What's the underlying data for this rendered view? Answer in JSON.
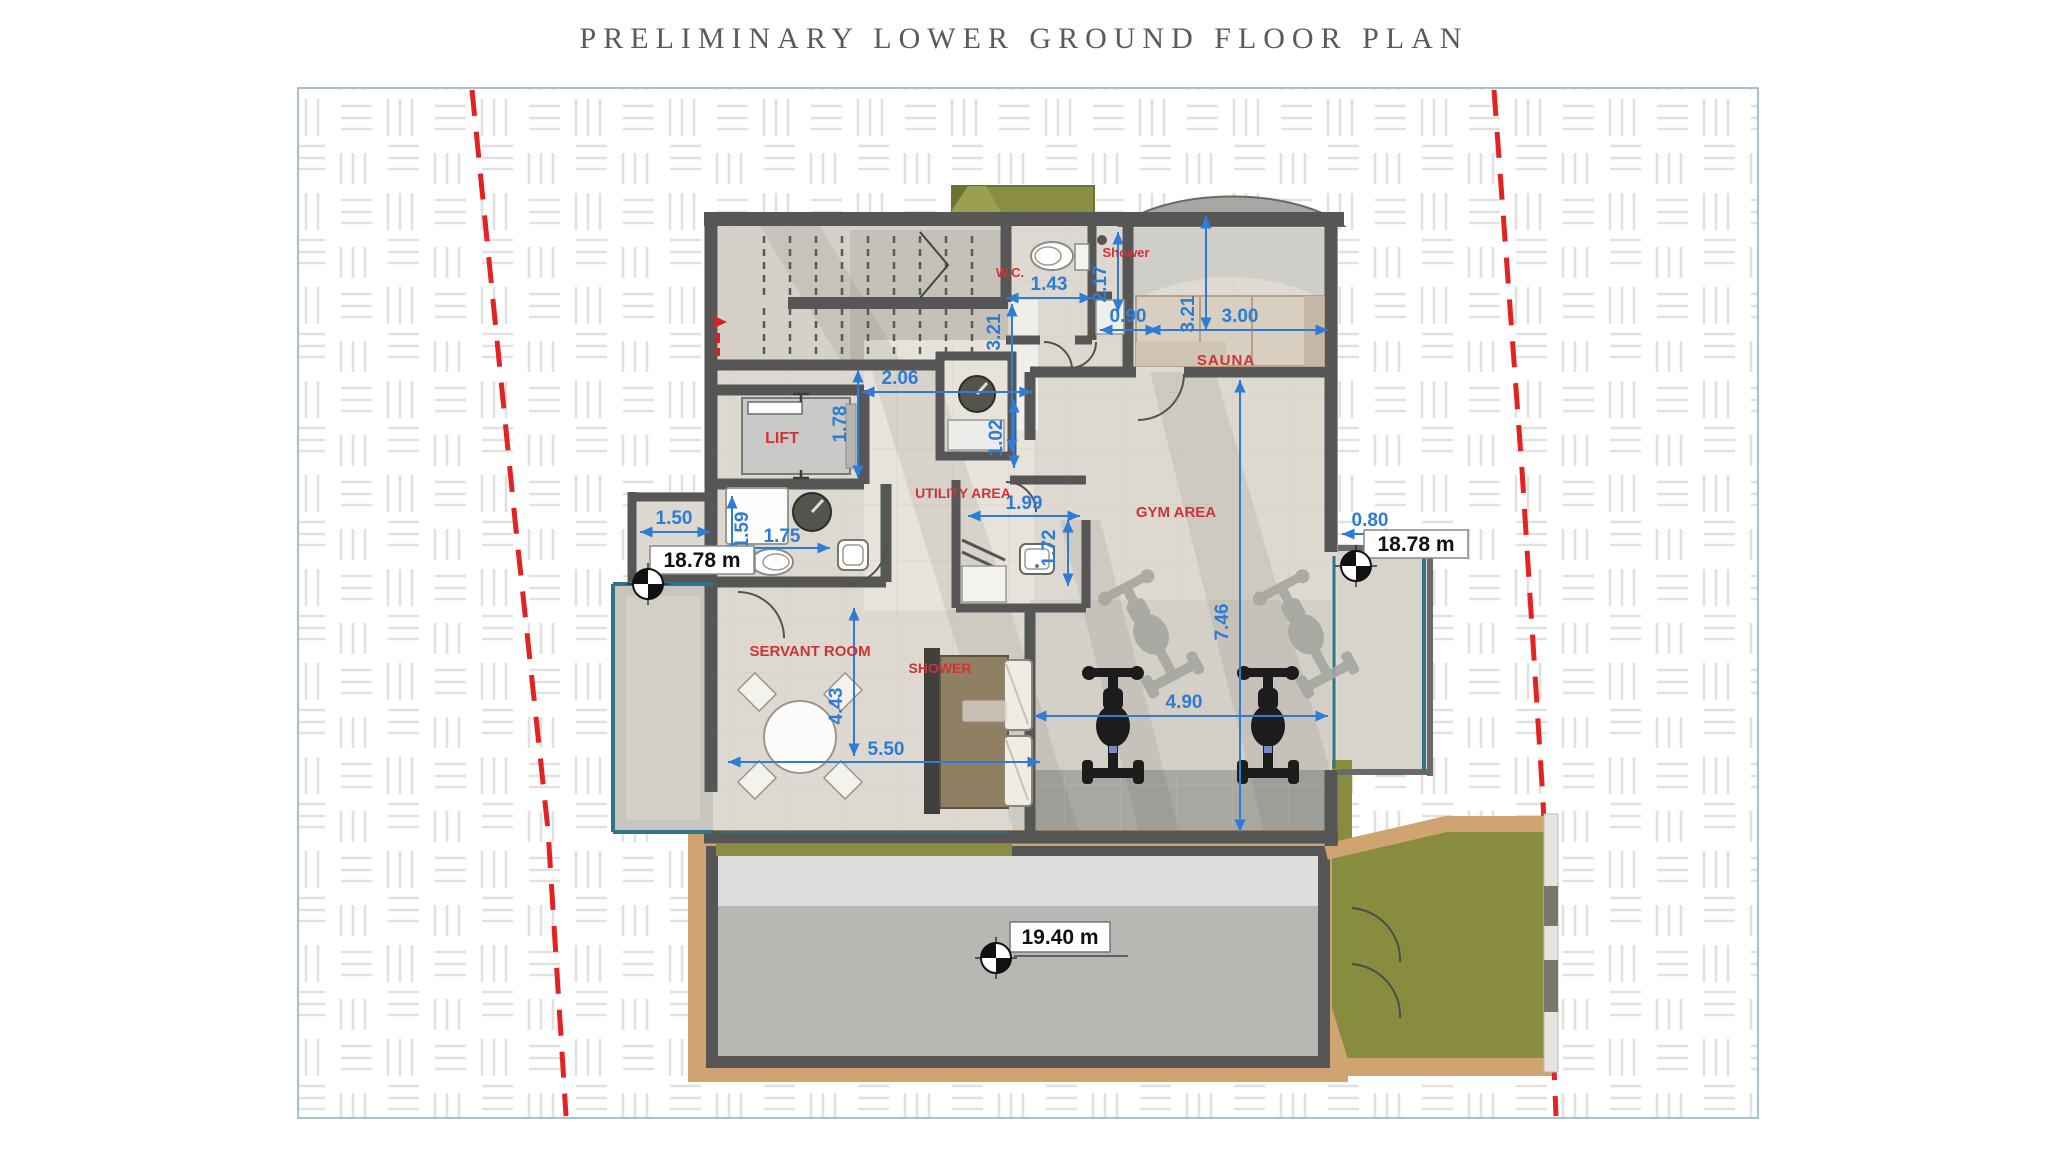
{
  "title": "PRELIMINARY LOWER GROUND FLOOR PLAN",
  "colors": {
    "dimension_blue": "#2e7cd6",
    "room_label_red": "#cf3434",
    "boundary_red": "#e32222",
    "wall_gray": "#565656",
    "garden_olive": "#878c3f",
    "deck_tan": "#cfa471",
    "glazing_teal": "#2e7586",
    "frame_border": "#a9c0cf"
  },
  "rooms": {
    "lift": "LIFT",
    "wc": "W.C.",
    "shower": "Shower",
    "sauna": "SAUNA",
    "utility": "UTILITY AREA",
    "gym": "GYM AREA",
    "servant": "SERVANT ROOM",
    "servant_shower": "SHOWER"
  },
  "dims": {
    "d206": "2.06",
    "d178": "1.78",
    "d143": "1.43",
    "d321a": "3.21",
    "d217": "2.17",
    "d090": "0.90",
    "d321b": "3.21",
    "d300": "3.00",
    "d102": "1.02",
    "d199": "1.99",
    "d172": "1.72",
    "d150": "1.50",
    "d159": "1.59",
    "d175": "1.75",
    "d443": "4.43",
    "d550": "5.50",
    "d746": "7.46",
    "d490": "4.90",
    "d080": "0.80"
  },
  "levels": {
    "left": "18.78 m",
    "right": "18.78 m",
    "pool": "19.40 m"
  }
}
